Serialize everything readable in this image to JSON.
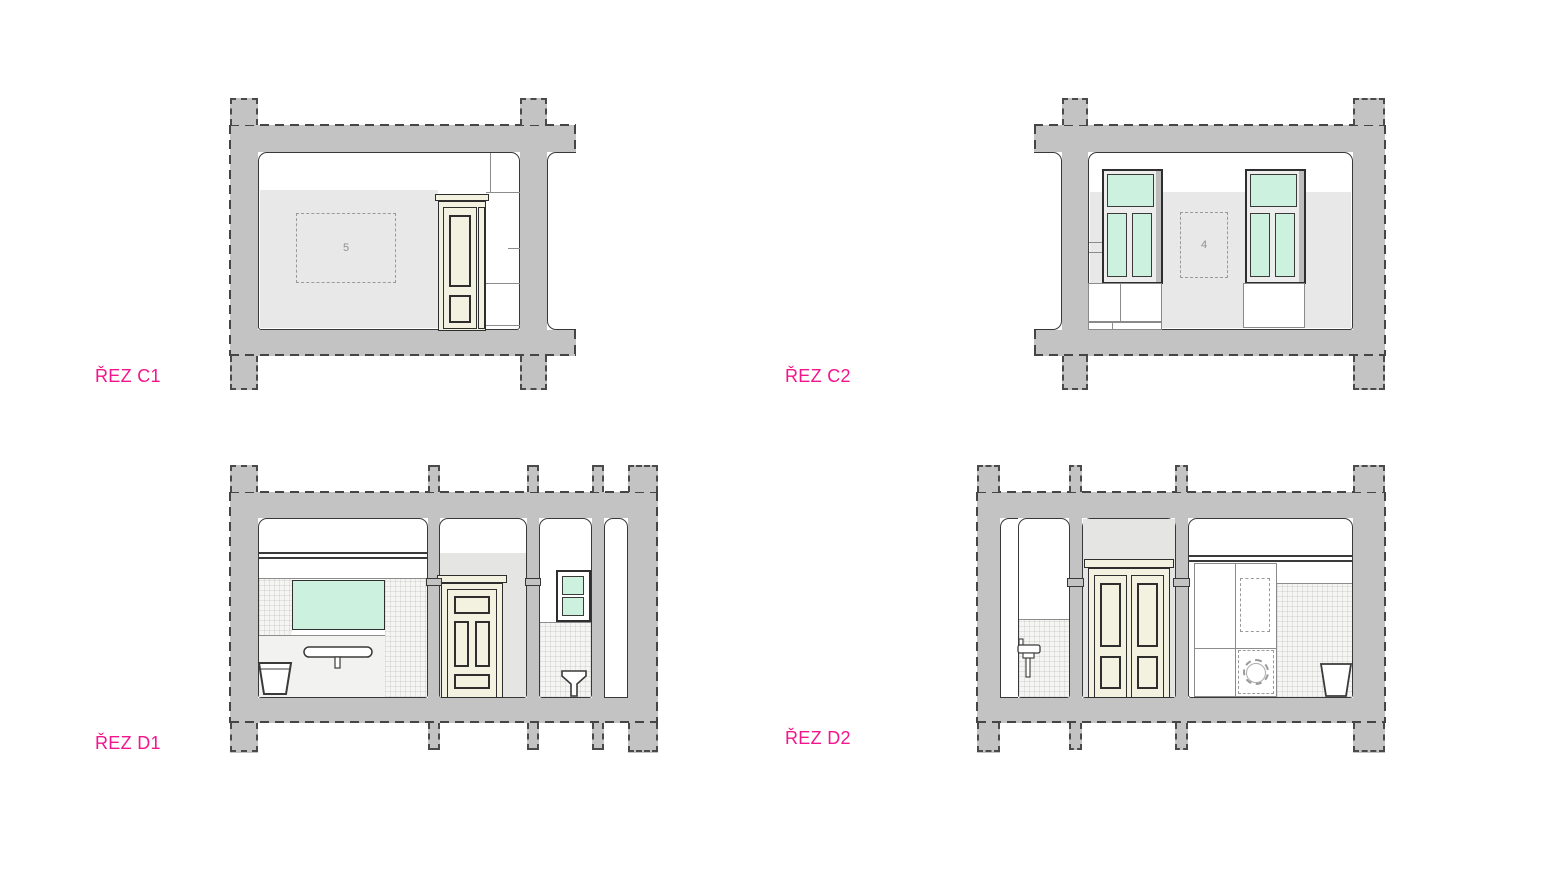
{
  "sections": {
    "c1": {
      "label": "ŘEZ C1",
      "room_number": "5"
    },
    "c2": {
      "label": "ŘEZ C2",
      "room_number": "4"
    },
    "d1": {
      "label": "ŘEZ D1"
    },
    "d2": {
      "label": "ŘEZ D2"
    }
  },
  "colors": {
    "label_pink": "#F4148C",
    "wall_cut_gray": "#C3C3C4",
    "interior_wall_gray": "#E8E8E8",
    "glass_mint": "#CDF1DF",
    "door_cream": "#F3F2E1",
    "outline_dark": "#383838"
  }
}
